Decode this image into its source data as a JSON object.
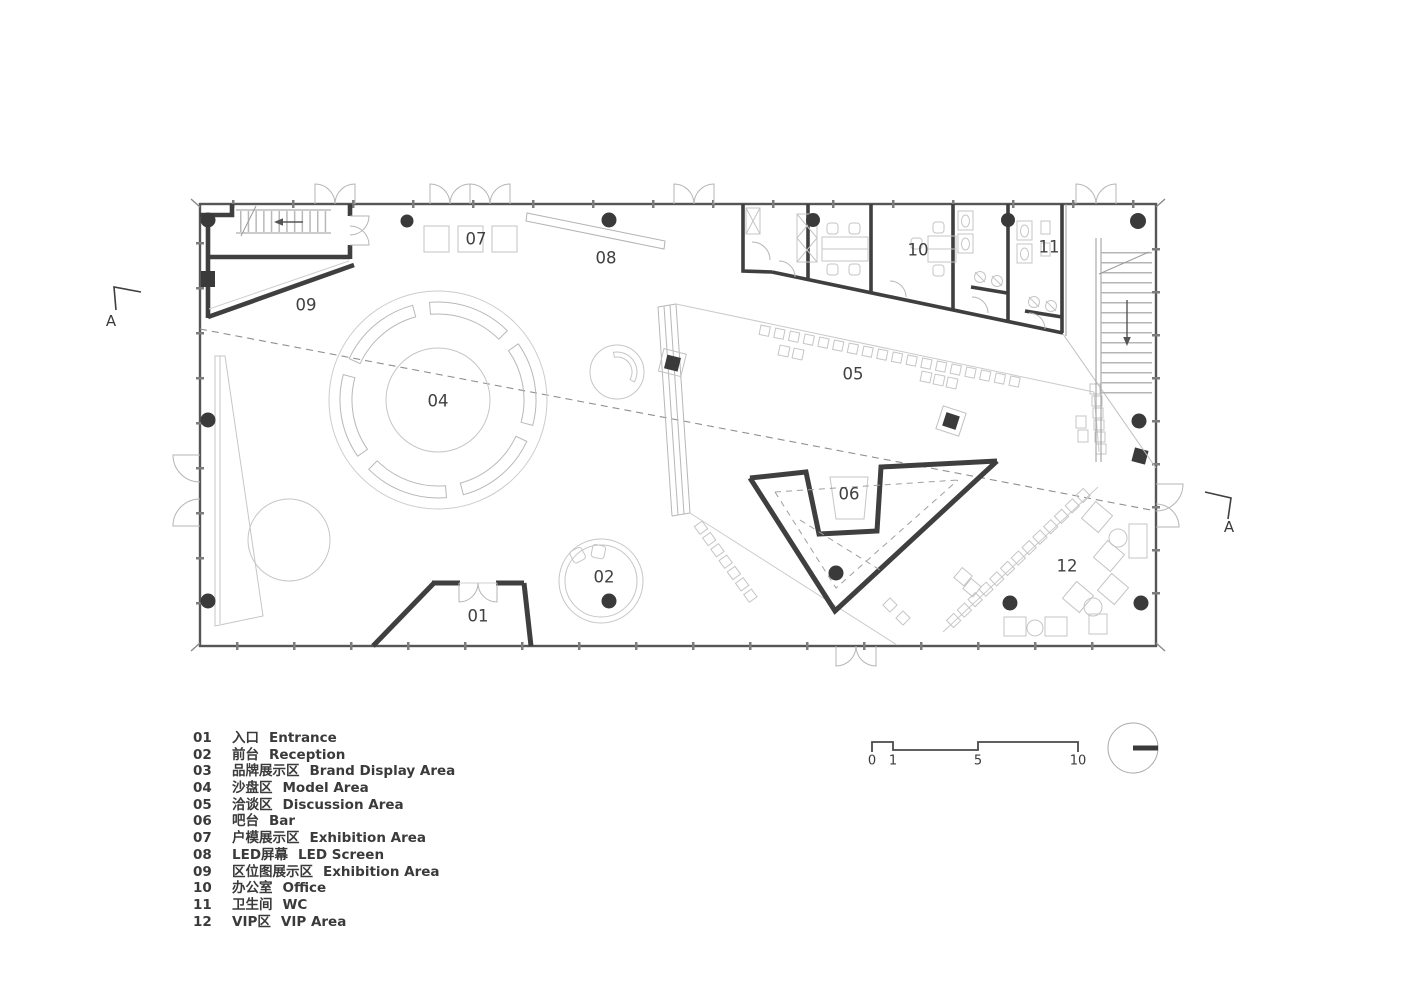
{
  "plan": {
    "room_labels": {
      "a01": "01",
      "a02": "02",
      "a04": "04",
      "a05": "05",
      "a06": "06",
      "a07": "07",
      "a08": "08",
      "a09": "09",
      "a10": "10",
      "a11": "11",
      "a12": "12"
    }
  },
  "section": {
    "label": "A"
  },
  "scale_bar": {
    "ticks": [
      "0",
      "1",
      "5",
      "10"
    ]
  },
  "legend": {
    "rows": [
      {
        "num": "01",
        "zh": "入口",
        "en": "Entrance"
      },
      {
        "num": "02",
        "zh": "前台",
        "en": "Reception"
      },
      {
        "num": "03",
        "zh": "品牌展示区",
        "en": "Brand Display Area"
      },
      {
        "num": "04",
        "zh": "沙盘区",
        "en": "Model Area"
      },
      {
        "num": "05",
        "zh": "洽谈区",
        "en": "Discussion Area"
      },
      {
        "num": "06",
        "zh": "吧台",
        "en": "Bar"
      },
      {
        "num": "07",
        "zh": "户模展示区",
        "en": "Exhibition Area"
      },
      {
        "num": "08",
        "zh": "LED屏幕",
        "en": "LED Screen"
      },
      {
        "num": "09",
        "zh": "区位图展示区",
        "en": "Exhibition Area"
      },
      {
        "num": "10",
        "zh": "办公室",
        "en": "Office"
      },
      {
        "num": "11",
        "zh": "卫生间",
        "en": "WC"
      },
      {
        "num": "12",
        "zh": "VIP区",
        "en": "VIP Area"
      }
    ]
  }
}
